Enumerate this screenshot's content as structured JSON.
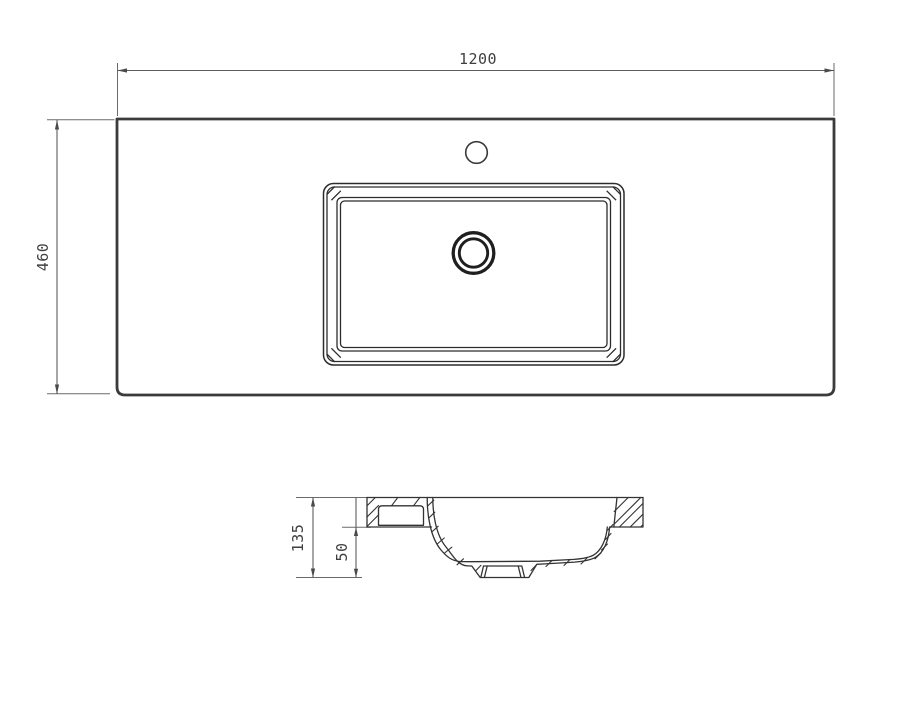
{
  "drawing": {
    "plan_view": {
      "width_dimension": "1200",
      "depth_dimension": "460"
    },
    "section_view": {
      "height_dimension": "135",
      "basin_depth_dimension": "50"
    },
    "colors": {
      "outline": "#3b3b3b",
      "detail_line": "#2c2c2c",
      "dimension_line": "#5c5c5c",
      "text": "#3f3f3f",
      "background": "#ffffff"
    }
  }
}
